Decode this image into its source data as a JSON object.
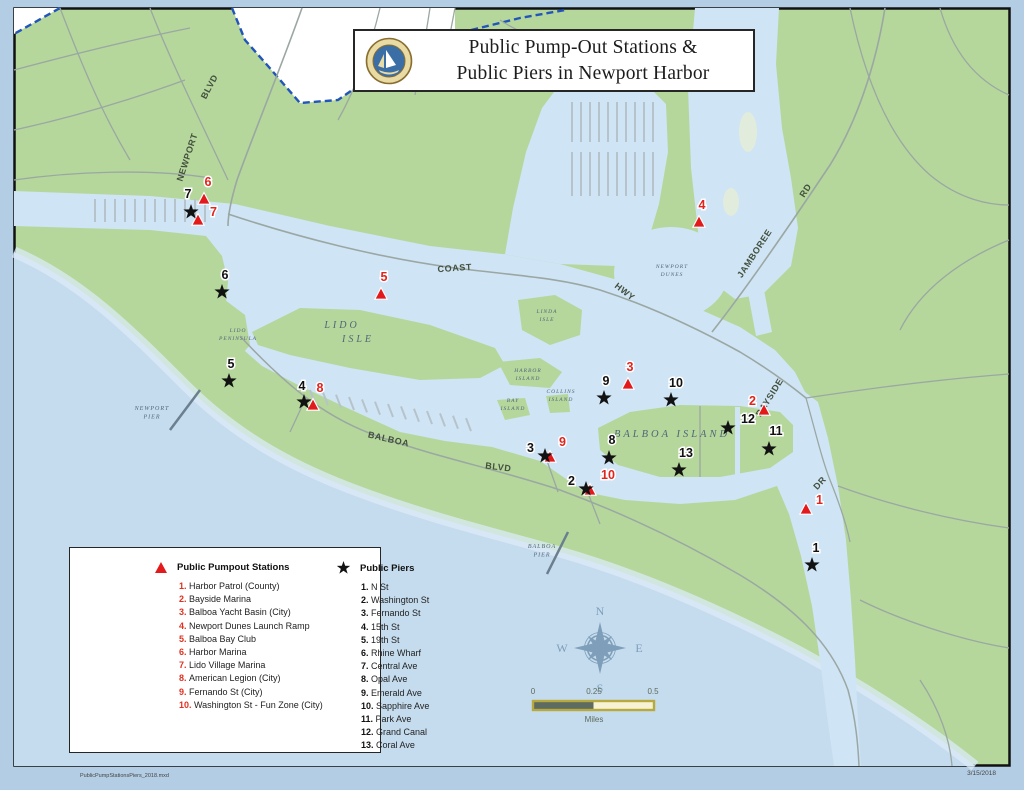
{
  "title": {
    "line1": "Public Pump-Out Stations &",
    "line2": "Public Piers in Newport Harbor"
  },
  "legend": {
    "pumpout": {
      "header": "Public Pumpout Stations",
      "items": [
        "Harbor Patrol (County)",
        "Bayside Marina",
        "Balboa Yacht Basin (City)",
        "Newport Dunes Launch Ramp",
        "Balboa Bay Club",
        "Harbor Marina",
        "Lido Village Marina",
        "American Legion (City)",
        "Fernando St (City)",
        "Washington St - Fun Zone (City)"
      ]
    },
    "piers": {
      "header": "Public Piers",
      "items": [
        "N St",
        "Washington St",
        "Fernando St",
        "15th St",
        "19th St",
        "Rhine Wharf",
        "Central Ave",
        "Opal Ave",
        "Emerald Ave",
        "Sapphire Ave",
        "Park Ave",
        "Grand Canal",
        "Coral Ave"
      ]
    }
  },
  "map": {
    "street_labels": [
      {
        "text": "NEWPORT",
        "x": 190,
        "y": 158,
        "rot": -72
      },
      {
        "text": "BLVD",
        "x": 212,
        "y": 88,
        "rot": -62
      },
      {
        "text": "COAST",
        "x": 455,
        "y": 271,
        "rot": -4
      },
      {
        "text": "HWY",
        "x": 623,
        "y": 294,
        "rot": 38
      },
      {
        "text": "JAMBOREE",
        "x": 757,
        "y": 255,
        "rot": -57
      },
      {
        "text": "RD",
        "x": 808,
        "y": 192,
        "rot": -57
      },
      {
        "text": "BAYSIDE",
        "x": 772,
        "y": 399,
        "rot": -58
      },
      {
        "text": "DR",
        "x": 822,
        "y": 485,
        "rot": -48
      },
      {
        "text": "BALBOA",
        "x": 388,
        "y": 442,
        "rot": 13
      },
      {
        "text": "BLVD",
        "x": 498,
        "y": 470,
        "rot": 7
      }
    ],
    "place_labels": [
      {
        "lines": [
          "LIDO",
          "PENINSULA"
        ],
        "x": 238,
        "y": 332,
        "size": 5.5
      },
      {
        "lines": [
          "LIDO"
        ],
        "x": 342,
        "y": 328,
        "size": 10
      },
      {
        "lines": [
          "ISLE"
        ],
        "x": 358,
        "y": 342,
        "size": 10
      },
      {
        "lines": [
          "LINDA",
          "ISLE"
        ],
        "x": 547,
        "y": 313,
        "size": 5.5
      },
      {
        "lines": [
          "NEWPORT",
          "DUNES"
        ],
        "x": 672,
        "y": 268,
        "size": 5.5
      },
      {
        "lines": [
          "HARBOR",
          "ISLAND"
        ],
        "x": 528,
        "y": 372,
        "size": 5.5
      },
      {
        "lines": [
          "BAY",
          "ISLAND"
        ],
        "x": 513,
        "y": 402,
        "size": 5.5
      },
      {
        "lines": [
          "COLLINS",
          "ISLAND"
        ],
        "x": 561,
        "y": 393,
        "size": 5.5
      },
      {
        "lines": [
          "BALBOA ISLAND"
        ],
        "x": 672,
        "y": 437,
        "size": 10.5
      },
      {
        "lines": [
          "NEWPORT",
          "PIER"
        ],
        "x": 152,
        "y": 410,
        "size": 6
      },
      {
        "lines": [
          "BALBOA",
          "PIER"
        ],
        "x": 542,
        "y": 548,
        "size": 6
      }
    ],
    "pumpout_markers": [
      {
        "n": 1,
        "x": 806,
        "y": 509,
        "lx": 816,
        "ly": 504,
        "a": "start"
      },
      {
        "n": 2,
        "x": 764,
        "y": 410,
        "lx": 756,
        "ly": 405,
        "a": "end"
      },
      {
        "n": 3,
        "x": 628,
        "y": 384,
        "lx": 630,
        "ly": 371,
        "a": "middle"
      },
      {
        "n": 4,
        "x": 699,
        "y": 222,
        "lx": 702,
        "ly": 209,
        "a": "middle"
      },
      {
        "n": 5,
        "x": 381,
        "y": 294,
        "lx": 384,
        "ly": 281,
        "a": "middle"
      },
      {
        "n": 6,
        "x": 204,
        "y": 199,
        "lx": 208,
        "ly": 186,
        "a": "middle"
      },
      {
        "n": 7,
        "x": 198,
        "y": 220,
        "lx": 210,
        "ly": 216,
        "a": "start"
      },
      {
        "n": 8,
        "x": 313,
        "y": 405,
        "lx": 320,
        "ly": 392,
        "a": "middle"
      },
      {
        "n": 9,
        "x": 550,
        "y": 457,
        "lx": 559,
        "ly": 446,
        "a": "start"
      },
      {
        "n": 10,
        "x": 590,
        "y": 490,
        "lx": 601,
        "ly": 479,
        "a": "start"
      }
    ],
    "pier_markers": [
      {
        "n": 1,
        "x": 812,
        "y": 565,
        "lx": 816,
        "ly": 552,
        "a": "middle"
      },
      {
        "n": 2,
        "x": 586,
        "y": 489,
        "lx": 575,
        "ly": 485,
        "a": "end"
      },
      {
        "n": 3,
        "x": 545,
        "y": 456,
        "lx": 534,
        "ly": 452,
        "a": "end"
      },
      {
        "n": 4,
        "x": 304,
        "y": 402,
        "lx": 302,
        "ly": 390,
        "a": "middle"
      },
      {
        "n": 5,
        "x": 229,
        "y": 381,
        "lx": 231,
        "ly": 368,
        "a": "middle"
      },
      {
        "n": 6,
        "x": 222,
        "y": 292,
        "lx": 225,
        "ly": 279,
        "a": "middle"
      },
      {
        "n": 7,
        "x": 191,
        "y": 212,
        "lx": 188,
        "ly": 198,
        "a": "middle"
      },
      {
        "n": 8,
        "x": 609,
        "y": 458,
        "lx": 612,
        "ly": 444,
        "a": "middle"
      },
      {
        "n": 9,
        "x": 604,
        "y": 398,
        "lx": 606,
        "ly": 385,
        "a": "middle"
      },
      {
        "n": 10,
        "x": 671,
        "y": 400,
        "lx": 676,
        "ly": 387,
        "a": "middle"
      },
      {
        "n": 11,
        "x": 769,
        "y": 449,
        "lx": 776,
        "ly": 435,
        "a": "middle"
      },
      {
        "n": 12,
        "x": 728,
        "y": 428,
        "lx": 741,
        "ly": 423,
        "a": "start"
      },
      {
        "n": 13,
        "x": 679,
        "y": 470,
        "lx": 686,
        "ly": 457,
        "a": "middle"
      }
    ]
  },
  "compass": {
    "n": "N",
    "e": "E",
    "s": "S",
    "w": "W"
  },
  "scalebar": {
    "t0": "0",
    "t1": "0.25",
    "t2": "0.5",
    "unit": "Miles"
  },
  "footer": {
    "file": "PublicPumpStationsPiers_2018.mxd",
    "date": "3/15/2018"
  },
  "colors": {
    "land": "#b5d79b",
    "harbor_water": "#cfe4f4",
    "ocean": "#c5dcee",
    "marker_red": "#e31a1c",
    "boundary_blue": "#2255bb",
    "scalebar_gold": "#b8a93e",
    "compass_blue": "#7e9eb9"
  }
}
